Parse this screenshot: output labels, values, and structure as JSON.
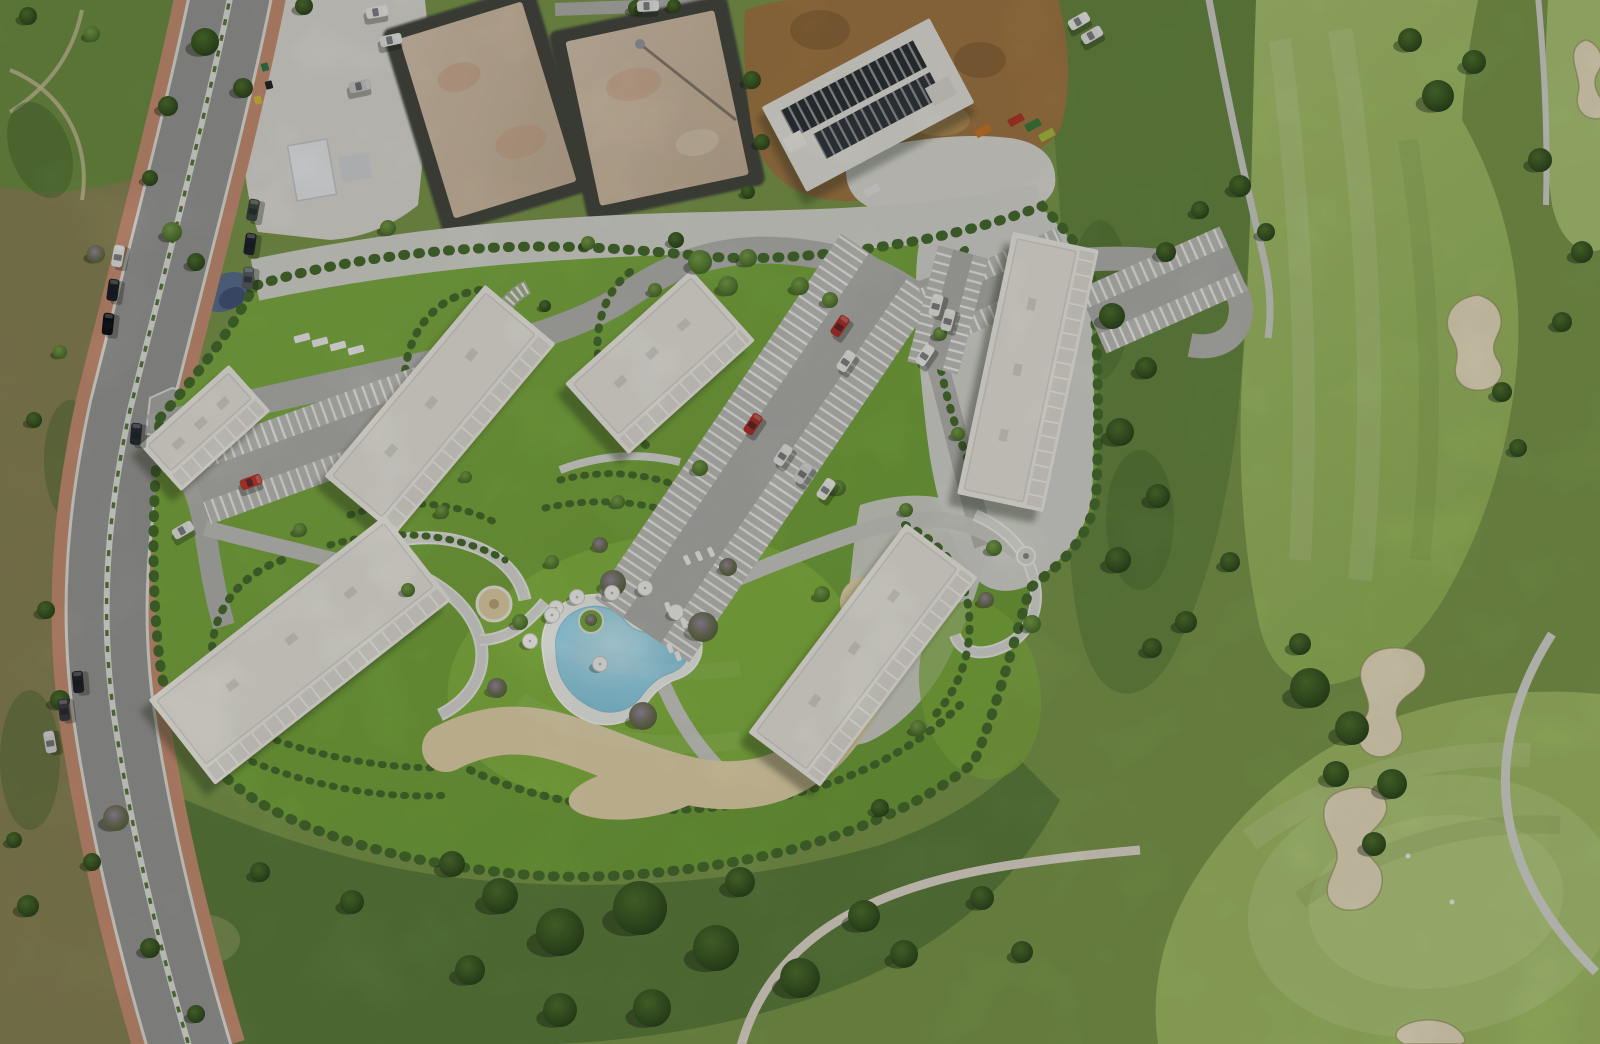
{
  "palette": {
    "base": "#7f9c4e",
    "lawn": "#7cab43",
    "lawnBright": "#8aba45",
    "scrubLeft": "#8d8858",
    "scrubTopLeft": "#729347",
    "scrubSouth": "#5e8040",
    "scrubEast": "#6a8c44",
    "scrubDark": "#49682f",
    "fairway": "#a5c168",
    "fairwayLight": "#b6cf7e",
    "golfGreen": "#b0ca78",
    "hedge": "#4a7030",
    "road": "#9c9c9a",
    "sidewalk": "#cd9377",
    "curb": "#e7e7e1",
    "drive": "#b8b8b4",
    "promenade": "#cfcfc9",
    "gardenPath": "#dfe0da",
    "pathCasing": "#f0f1eb",
    "gravel": "#e2e1da",
    "gravelBand": "#dcdcd5",
    "dirt": "#a57b47",
    "slab": "#d5c2aa",
    "trench": "#464b42",
    "building": "#f4f2ea",
    "buildingRoof": "#edebe2",
    "buildingLine": "#dbd9cf",
    "balcony": "#e4e2d8",
    "parkingBase": "#b4b4b0",
    "parkingStall": "#c3c3bf",
    "poolDeck": "#f2f4ee",
    "poolWater": "#a9dff0",
    "sand": "#e8d9ae",
    "bunker": "#ece3c4",
    "hardscape": "#dadad4",
    "carRed": "#b3322a"
  },
  "scene": {
    "buildings": [
      {
        "id": "block-a",
        "cx": 440,
        "cy": 410,
        "l": 250,
        "w": 92,
        "a": -50
      },
      {
        "id": "block-b",
        "cx": 660,
        "cy": 362,
        "l": 170,
        "w": 95,
        "a": -42
      },
      {
        "id": "block-c",
        "cx": 1028,
        "cy": 372,
        "l": 268,
        "w": 88,
        "a": -78
      },
      {
        "id": "block-d",
        "cx": 863,
        "cy": 655,
        "l": 262,
        "w": 90,
        "a": -53
      },
      {
        "id": "block-e",
        "cx": 300,
        "cy": 650,
        "l": 300,
        "w": 108,
        "a": -38
      },
      {
        "id": "block-f",
        "cx": 205,
        "cy": 428,
        "l": 120,
        "w": 62,
        "a": -42
      }
    ],
    "parking": [
      {
        "id": "central",
        "cx": 765,
        "cy": 448,
        "l": 440,
        "w": 114,
        "a": -56
      },
      {
        "id": "northwest",
        "cx": 320,
        "cy": 443,
        "l": 260,
        "w": 78,
        "a": -20
      },
      {
        "id": "northeast-1",
        "cx": 1000,
        "cy": 287,
        "l": 150,
        "w": 62,
        "a": -24
      },
      {
        "id": "northeast-2",
        "cx": 1163,
        "cy": 290,
        "l": 155,
        "w": 70,
        "a": -24
      },
      {
        "id": "block-c-west",
        "cx": 948,
        "cy": 310,
        "l": 120,
        "w": 52,
        "a": -75
      }
    ],
    "trees": [
      [
        28,
        16,
        9,
        "d"
      ],
      [
        92,
        34,
        8,
        "l"
      ],
      [
        168,
        106,
        10,
        "d"
      ],
      [
        150,
        178,
        8,
        "d"
      ],
      [
        96,
        254,
        9,
        "s"
      ],
      [
        60,
        352,
        7,
        "l"
      ],
      [
        34,
        420,
        8,
        "d"
      ],
      [
        46,
        610,
        9,
        "d"
      ],
      [
        60,
        700,
        10,
        "d"
      ],
      [
        116,
        818,
        13,
        "s"
      ],
      [
        92,
        862,
        9,
        "d"
      ],
      [
        150,
        948,
        10,
        "d"
      ],
      [
        196,
        1014,
        9,
        "d"
      ],
      [
        28,
        906,
        11,
        "d"
      ],
      [
        14,
        840,
        8,
        "d"
      ],
      [
        205,
        42,
        14,
        "d"
      ],
      [
        243,
        88,
        10,
        "d"
      ],
      [
        304,
        6,
        9,
        "d"
      ],
      [
        172,
        232,
        10,
        "l"
      ],
      [
        196,
        262,
        9,
        "d"
      ],
      [
        388,
        228,
        8,
        "l"
      ],
      [
        752,
        80,
        9,
        "d"
      ],
      [
        762,
        142,
        8,
        "d"
      ],
      [
        748,
        192,
        7,
        "d"
      ],
      [
        636,
        8,
        8,
        "d"
      ],
      [
        674,
        6,
        7,
        "d"
      ],
      [
        700,
        262,
        12,
        "l"
      ],
      [
        728,
        286,
        10,
        "l"
      ],
      [
        748,
        258,
        9,
        "l"
      ],
      [
        676,
        240,
        8,
        "d"
      ],
      [
        655,
        290,
        7,
        "l"
      ],
      [
        588,
        243,
        7,
        "l"
      ],
      [
        800,
        286,
        9,
        "l"
      ],
      [
        830,
        300,
        8,
        "l"
      ],
      [
        545,
        306,
        6,
        "d"
      ],
      [
        700,
        468,
        8,
        "l"
      ],
      [
        618,
        502,
        7,
        "l"
      ],
      [
        838,
        488,
        8,
        "l"
      ],
      [
        520,
        622,
        8,
        "l"
      ],
      [
        552,
        562,
        7,
        "l"
      ],
      [
        442,
        512,
        7,
        "l"
      ],
      [
        466,
        477,
        6,
        "l"
      ],
      [
        940,
        334,
        7,
        "l"
      ],
      [
        958,
        434,
        7,
        "l"
      ],
      [
        906,
        510,
        7,
        "l"
      ],
      [
        994,
        548,
        8,
        "l"
      ],
      [
        1032,
        624,
        9,
        "l"
      ],
      [
        986,
        600,
        8,
        "s"
      ],
      [
        880,
        808,
        9,
        "d"
      ],
      [
        822,
        594,
        8,
        "l"
      ],
      [
        918,
        728,
        8,
        "l"
      ],
      [
        408,
        590,
        7,
        "l"
      ],
      [
        300,
        530,
        7,
        "l"
      ],
      [
        1112,
        316,
        13,
        "d"
      ],
      [
        1146,
        368,
        11,
        "d"
      ],
      [
        1120,
        432,
        14,
        "d"
      ],
      [
        1158,
        496,
        12,
        "d"
      ],
      [
        1118,
        560,
        13,
        "d"
      ],
      [
        1166,
        252,
        10,
        "d"
      ],
      [
        1200,
        210,
        9,
        "d"
      ],
      [
        1230,
        562,
        10,
        "d"
      ],
      [
        1186,
        622,
        11,
        "d"
      ],
      [
        1152,
        648,
        10,
        "d"
      ],
      [
        1240,
        186,
        11,
        "d"
      ],
      [
        1266,
        232,
        9,
        "d"
      ],
      [
        1438,
        96,
        16,
        "d"
      ],
      [
        1474,
        62,
        12,
        "d"
      ],
      [
        1410,
        40,
        12,
        "d"
      ],
      [
        1502,
        392,
        10,
        "d"
      ],
      [
        1518,
        448,
        9,
        "d"
      ],
      [
        1310,
        688,
        20,
        "d"
      ],
      [
        1352,
        728,
        17,
        "d"
      ],
      [
        1392,
        784,
        15,
        "d"
      ],
      [
        1336,
        774,
        13,
        "d"
      ],
      [
        1300,
        644,
        11,
        "d"
      ],
      [
        1374,
        844,
        12,
        "d"
      ],
      [
        1582,
        252,
        11,
        "d"
      ],
      [
        1562,
        322,
        10,
        "d"
      ],
      [
        1540,
        160,
        12,
        "d"
      ],
      [
        560,
        932,
        24,
        "d"
      ],
      [
        640,
        908,
        27,
        "d"
      ],
      [
        716,
        948,
        23,
        "d"
      ],
      [
        800,
        978,
        20,
        "d"
      ],
      [
        864,
        916,
        16,
        "d"
      ],
      [
        904,
        954,
        14,
        "d"
      ],
      [
        652,
        1008,
        19,
        "d"
      ],
      [
        500,
        896,
        18,
        "d"
      ],
      [
        452,
        864,
        13,
        "d"
      ],
      [
        740,
        882,
        15,
        "d"
      ],
      [
        982,
        898,
        12,
        "d"
      ],
      [
        1022,
        952,
        11,
        "d"
      ],
      [
        560,
        1010,
        17,
        "d"
      ],
      [
        470,
        970,
        15,
        "d"
      ],
      [
        352,
        902,
        12,
        "d"
      ],
      [
        260,
        872,
        10,
        "d"
      ]
    ],
    "shrubs": [
      [
        613,
        583,
        13
      ],
      [
        703,
        627,
        15
      ],
      [
        643,
        716,
        14
      ],
      [
        497,
        688,
        10
      ],
      [
        728,
        567,
        9
      ],
      [
        600,
        545,
        8
      ]
    ],
    "cars": [
      [
        253,
        210,
        -80,
        "#3d4a40"
      ],
      [
        250,
        244,
        -82,
        "#23262d"
      ],
      [
        248,
        278,
        -84,
        "#596067"
      ],
      [
        118,
        256,
        -80,
        "#e8e8e6"
      ],
      [
        113,
        290,
        -82,
        "#1d2027"
      ],
      [
        108,
        324,
        -84,
        "#0f1115"
      ],
      [
        136,
        434,
        -85,
        "#2a3038"
      ],
      [
        78,
        682,
        -95,
        "#23262c"
      ],
      [
        64,
        710,
        -97,
        "#3a3e45"
      ],
      [
        50,
        742,
        -100,
        "#dadad8"
      ],
      [
        377,
        12,
        -10,
        "#f1f1ef"
      ],
      [
        391,
        40,
        -12,
        "#eaeae8"
      ],
      [
        360,
        86,
        -12,
        "#cfcfcc"
      ],
      [
        648,
        6,
        -3,
        "#ececea"
      ],
      [
        183,
        530,
        -30,
        "#eaebe9"
      ],
      [
        251,
        482,
        -20,
        "#c23b2f"
      ],
      [
        840,
        326,
        -56,
        "#b3322a"
      ],
      [
        846,
        361,
        -56,
        "#f0efeb"
      ],
      [
        753,
        424,
        -56,
        "#b3322a"
      ],
      [
        783,
        455,
        -56,
        "#e9e9e5"
      ],
      [
        803,
        473,
        -56,
        "#dadad6"
      ],
      [
        826,
        489,
        -56,
        "#f0f0ec"
      ],
      [
        925,
        355,
        -56,
        "#f2f2ee"
      ],
      [
        936,
        305,
        -75,
        "#efefeb"
      ],
      [
        948,
        320,
        -75,
        "#e8e8e4"
      ],
      [
        1079,
        21,
        -30,
        "#f1f1ef"
      ],
      [
        1092,
        35,
        -30,
        "#e9e9e7"
      ]
    ],
    "umbrellas": [
      [
        556,
        608
      ],
      [
        577,
        597
      ],
      [
        612,
        593
      ],
      [
        645,
        588
      ],
      [
        552,
        615
      ],
      [
        530,
        641
      ],
      [
        600,
        664
      ],
      [
        676,
        612
      ]
    ],
    "loungers": [
      [
        668,
        607,
        -20
      ],
      [
        676,
        615,
        -20
      ],
      [
        684,
        623,
        -20
      ],
      [
        670,
        648,
        -20
      ],
      [
        678,
        656,
        -20
      ],
      [
        687,
        560,
        -25
      ],
      [
        699,
        556,
        -25
      ],
      [
        711,
        552,
        -25
      ]
    ],
    "bunkers": [
      {
        "id": "north",
        "d": "M1478,295 C1498,300 1506,318 1498,334 C1492,346 1492,352 1499,362 C1506,374 1498,388 1482,390 C1464,392 1452,380 1456,364 C1459,352 1456,344 1450,334 C1442,318 1452,298 1478,295 Z"
      },
      {
        "id": "mid",
        "d": "M1390,648 C1416,646 1430,660 1424,678 C1418,692 1404,694 1398,706 C1392,720 1404,724 1402,740 C1398,756 1378,762 1366,752 C1354,742 1358,728 1366,716 C1372,706 1366,696 1362,684 C1356,666 1368,650 1390,648 Z"
      },
      {
        "id": "south",
        "d": "M1352,788 C1374,784 1390,796 1386,812 C1382,826 1368,830 1366,844 C1364,858 1380,860 1382,876 C1384,894 1372,908 1354,910 C1336,912 1324,900 1328,884 C1332,870 1340,862 1336,848 C1332,836 1322,826 1324,810 C1326,796 1336,791 1352,788 Z"
      },
      {
        "id": "edge-ne",
        "d": "M1586,40 C1600,44 1606,60 1598,72 C1592,82 1596,92 1602,100 L1602,118 C1586,122 1574,110 1578,94 C1581,84 1576,74 1574,62 C1572,50 1577,42 1586,40 Z"
      },
      {
        "id": "edge-s",
        "d": "M1398,1030 C1410,1018 1440,1016 1456,1028 C1468,1038 1466,1044 1460,1044 L1404,1044 C1396,1040 1394,1035 1398,1030 Z"
      }
    ],
    "bins": [
      [
        265,
        67,
        "#2f7d4f"
      ],
      [
        269,
        85,
        "#23262c"
      ],
      [
        258,
        100,
        "#d8c13a"
      ]
    ],
    "containers": [
      [
        1016,
        120,
        "#b53a2e"
      ],
      [
        1033,
        125,
        "#3f7d3b"
      ],
      [
        1047,
        135,
        "#a9c43e"
      ],
      [
        983,
        131,
        "#d07a2a"
      ],
      [
        872,
        190,
        "#e8e8e6"
      ]
    ],
    "trailers": [
      [
        302,
        338
      ],
      [
        320,
        342
      ],
      [
        338,
        346
      ],
      [
        356,
        350
      ]
    ],
    "golfers": [
      [
        1408,
        856
      ],
      [
        1452,
        902
      ]
    ]
  }
}
